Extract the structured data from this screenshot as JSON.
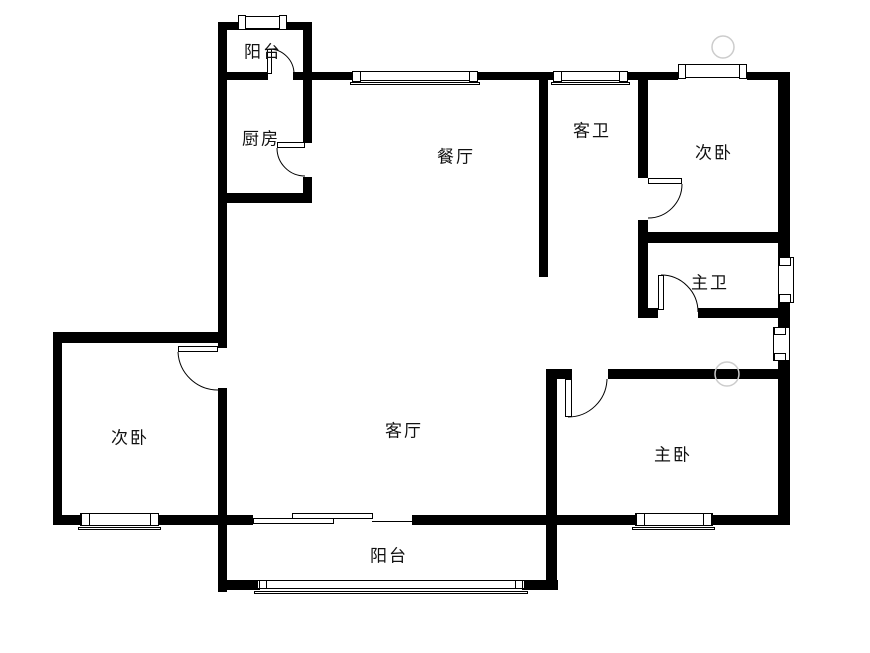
{
  "canvas": {
    "width": 870,
    "height": 653,
    "background": "#ffffff",
    "wall_color": "#000000",
    "label_color": "#111111",
    "watermark_color": "#cccccc"
  },
  "rooms": [
    {
      "id": "balcony-top",
      "label": "阳台",
      "x": 263,
      "y": 52
    },
    {
      "id": "kitchen",
      "label": "厨房",
      "x": 261,
      "y": 139
    },
    {
      "id": "dining-room",
      "label": "餐厅",
      "x": 456,
      "y": 157
    },
    {
      "id": "guest-bathroom",
      "label": "客卫",
      "x": 592,
      "y": 131
    },
    {
      "id": "second-bedroom-right",
      "label": "次卧",
      "x": 714,
      "y": 153
    },
    {
      "id": "master-bathroom",
      "label": "主卫",
      "x": 710,
      "y": 283
    },
    {
      "id": "second-bedroom-left",
      "label": "次卧",
      "x": 130,
      "y": 438
    },
    {
      "id": "living-room",
      "label": "客厅",
      "x": 404,
      "y": 431
    },
    {
      "id": "master-bedroom",
      "label": "主卧",
      "x": 673,
      "y": 455
    },
    {
      "id": "balcony-bottom",
      "label": "阳台",
      "x": 389,
      "y": 556
    }
  ],
  "floorplan": {
    "walls": [
      [
        218,
        22,
        9,
        326
      ],
      [
        218,
        388,
        9,
        204
      ],
      [
        218,
        22,
        92,
        8
      ],
      [
        303,
        22,
        9,
        121
      ],
      [
        303,
        177,
        9,
        26
      ],
      [
        218,
        72,
        50,
        8
      ],
      [
        293,
        72,
        10,
        8
      ],
      [
        303,
        72,
        50,
        8
      ],
      [
        478,
        72,
        75,
        8
      ],
      [
        628,
        72,
        50,
        8
      ],
      [
        747,
        72,
        43,
        8
      ],
      [
        778,
        72,
        12,
        186
      ],
      [
        778,
        303,
        12,
        25
      ],
      [
        778,
        360,
        12,
        164
      ],
      [
        227,
        193,
        85,
        10
      ],
      [
        539,
        80,
        9,
        197
      ],
      [
        638,
        80,
        10,
        98
      ],
      [
        638,
        220,
        10,
        98
      ],
      [
        638,
        232,
        152,
        11
      ],
      [
        638,
        308,
        20,
        10
      ],
      [
        698,
        308,
        92,
        10
      ],
      [
        546,
        369,
        26,
        10
      ],
      [
        608,
        369,
        182,
        10
      ],
      [
        546,
        369,
        11,
        221
      ],
      [
        53,
        332,
        165,
        11
      ],
      [
        53,
        332,
        9,
        193
      ],
      [
        53,
        515,
        29,
        10
      ],
      [
        158,
        515,
        69,
        10
      ],
      [
        227,
        515,
        26,
        10
      ],
      [
        412,
        515,
        146,
        10
      ],
      [
        558,
        515,
        79,
        10
      ],
      [
        710,
        515,
        80,
        10
      ],
      [
        218,
        580,
        42,
        10
      ],
      [
        522,
        580,
        36,
        10
      ]
    ],
    "window_boxes": [
      [
        238,
        16,
        49,
        13
      ],
      [
        238,
        15,
        8,
        15
      ],
      [
        279,
        15,
        8,
        15
      ],
      [
        352,
        71,
        126,
        10
      ],
      [
        352,
        71,
        9,
        11
      ],
      [
        469,
        71,
        9,
        11
      ],
      [
        350,
        82,
        130,
        3
      ],
      [
        553,
        71,
        75,
        10
      ],
      [
        553,
        71,
        9,
        11
      ],
      [
        619,
        71,
        9,
        11
      ],
      [
        551,
        82,
        79,
        3
      ],
      [
        678,
        64,
        69,
        14
      ],
      [
        678,
        64,
        8,
        15
      ],
      [
        739,
        64,
        8,
        15
      ],
      [
        778,
        257,
        16,
        46
      ],
      [
        779,
        257,
        12,
        9
      ],
      [
        779,
        294,
        12,
        9
      ],
      [
        773,
        327,
        17,
        34
      ],
      [
        774,
        327,
        12,
        8
      ],
      [
        774,
        353,
        12,
        8
      ],
      [
        635,
        513,
        78,
        13
      ],
      [
        636,
        513,
        9,
        13
      ],
      [
        703,
        513,
        9,
        13
      ],
      [
        632,
        527,
        83,
        3
      ],
      [
        80,
        513,
        79,
        13
      ],
      [
        81,
        513,
        9,
        13
      ],
      [
        150,
        513,
        9,
        13
      ],
      [
        78,
        527,
        83,
        3
      ],
      [
        257,
        580,
        268,
        9
      ],
      [
        259,
        580,
        8,
        9
      ],
      [
        515,
        580,
        8,
        9
      ],
      [
        254,
        591,
        274,
        3
      ],
      [
        253,
        518,
        81,
        6
      ],
      [
        292,
        513,
        81,
        6
      ]
    ],
    "door_leaves": [
      [
        267,
        49,
        5,
        25
      ],
      [
        277,
        142,
        28,
        6
      ],
      [
        178,
        346,
        40,
        6
      ],
      [
        648,
        178,
        34,
        6
      ],
      [
        658,
        275,
        6,
        35
      ],
      [
        565,
        379,
        7,
        38
      ]
    ],
    "door_arcs": [
      "M269,49 A25,25 0 0 1 294,74",
      "M277,148 A28,28 0 0 0 305,176",
      "M178,352 A40,40 0 0 0 218,390",
      "M682,184 A34,34 0 0 1 648,218",
      "M661,275 A37,37 0 0 1 698,312",
      "M568,417 A39,39 0 0 0 607,379"
    ],
    "lines": [
      [
        372,
        521,
        40,
        1
      ]
    ],
    "watermarks": [
      [
        723,
        47,
        11
      ],
      [
        727,
        374,
        12
      ]
    ]
  }
}
